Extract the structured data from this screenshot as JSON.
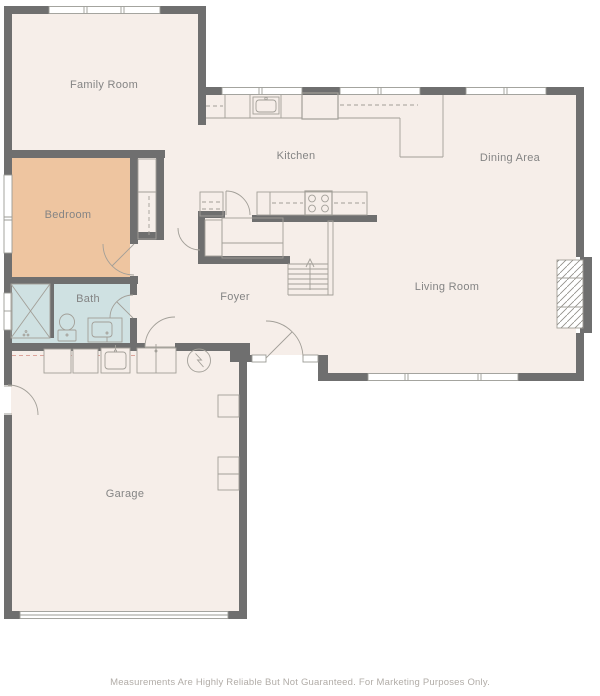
{
  "floorplan": {
    "rooms": [
      {
        "id": "family-room",
        "label": "Family Room"
      },
      {
        "id": "kitchen",
        "label": "Kitchen"
      },
      {
        "id": "dining-area",
        "label": "Dining Area"
      },
      {
        "id": "bedroom",
        "label": "Bedroom"
      },
      {
        "id": "bath",
        "label": "Bath"
      },
      {
        "id": "foyer",
        "label": "Foyer"
      },
      {
        "id": "living-room",
        "label": "Living Room"
      },
      {
        "id": "garage",
        "label": "Garage"
      }
    ],
    "colors": {
      "wall": "#6f6f6f",
      "floor": "#f6eee9",
      "bedroom": "#eec5a0",
      "bath": "#cfe1e2",
      "window_line": "#9b9b95",
      "fixture": "#a29f98",
      "label": "#848484",
      "accent_dash": "#dca49b",
      "footer_text": "#b1aca7"
    }
  },
  "footer": {
    "disclaimer": "Measurements Are Highly Reliable But Not Guaranteed. For Marketing Purposes Only."
  }
}
